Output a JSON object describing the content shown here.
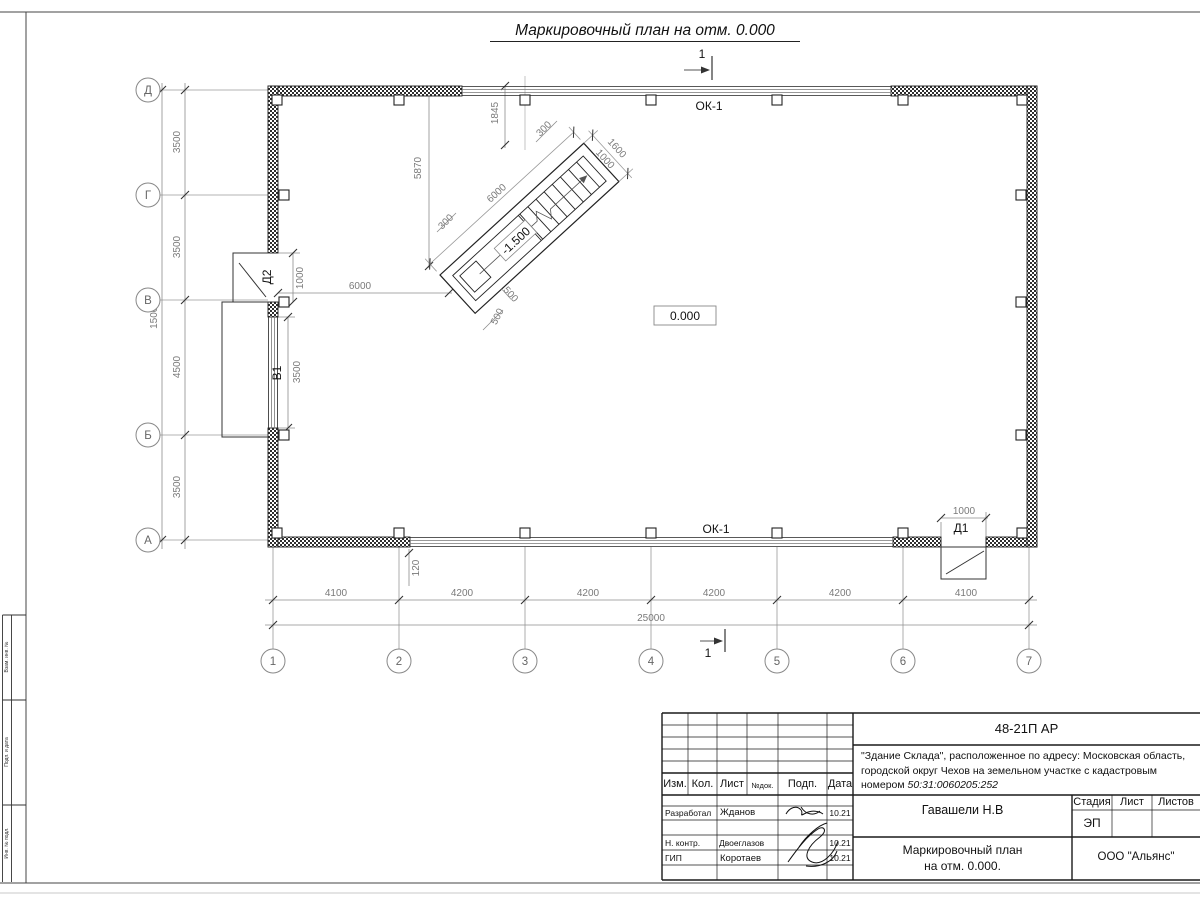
{
  "sheet": {
    "title": "Маркировочный план на отм. 0.000",
    "section_label": "1",
    "level_mark": "0.000",
    "stair_level_mark": "-1.500"
  },
  "axes": {
    "rows": [
      "Д",
      "Г",
      "В",
      "Б",
      "А"
    ],
    "cols": [
      "1",
      "2",
      "3",
      "4",
      "5",
      "6",
      "7"
    ]
  },
  "dims": {
    "row_segs": [
      "3500",
      "3500",
      "4500",
      "3500"
    ],
    "row_total": "15000",
    "col_segs": [
      "4100",
      "4200",
      "4200",
      "4200",
      "4200",
      "4100"
    ],
    "col_total": "25000",
    "wall_offset": "120",
    "d2_width": "1000",
    "b1_width": "3500",
    "wall_to_stair": "6000",
    "d1_width": "1000",
    "stair_length": "6000",
    "stair_width": "1600",
    "stair_inner": "1000",
    "stair_wall_a": "300",
    "stair_wall_b": "300",
    "stair_top_offset": "1845",
    "stair_left_offset": "5870",
    "stair_s1": "500",
    "stair_s2": "500"
  },
  "labels": {
    "window_top": "ОК-1",
    "window_bottom": "ОК-1",
    "door1": "Д1",
    "door2": "Д2",
    "gate1": "В1"
  },
  "side_stamp": {
    "box1": "Взам. инв. №",
    "box2": "Подп. и дата",
    "box3": "Инв. № подл."
  },
  "titleblock": {
    "doc_code": "48-21П АР",
    "desc_line1": "\"Здание Склада\", расположенное по адресу: Московская область,",
    "desc_line2": "городской округ Чехов на земельном участке с кадастровым",
    "desc_line3_prefix": "номером ",
    "cadastral": "50:31:0060205:252",
    "cols": {
      "izm": "Изм.",
      "kol": "Кол.",
      "list": "Лист",
      "ndoc": "№док.",
      "podp": "Подп.",
      "data": "Дата"
    },
    "rows": [
      {
        "role": "Разработал",
        "name": "Жданов",
        "date": "10.21"
      },
      {
        "role": "Н. контр.",
        "name": "Двоеглазов",
        "date": "10.21"
      },
      {
        "role": "ГИП",
        "name": "Коротаев",
        "date": "10.21"
      }
    ],
    "author": "Гавашели Н.В",
    "stage_label": "Стадия",
    "sheet_label": "Лист",
    "sheets_label": "Листов",
    "stage_value": "ЭП",
    "drawing_title_line1": "Маркировочный план",
    "drawing_title_line2": "на отм. 0.000.",
    "company": "ООО \"Альянс\""
  }
}
